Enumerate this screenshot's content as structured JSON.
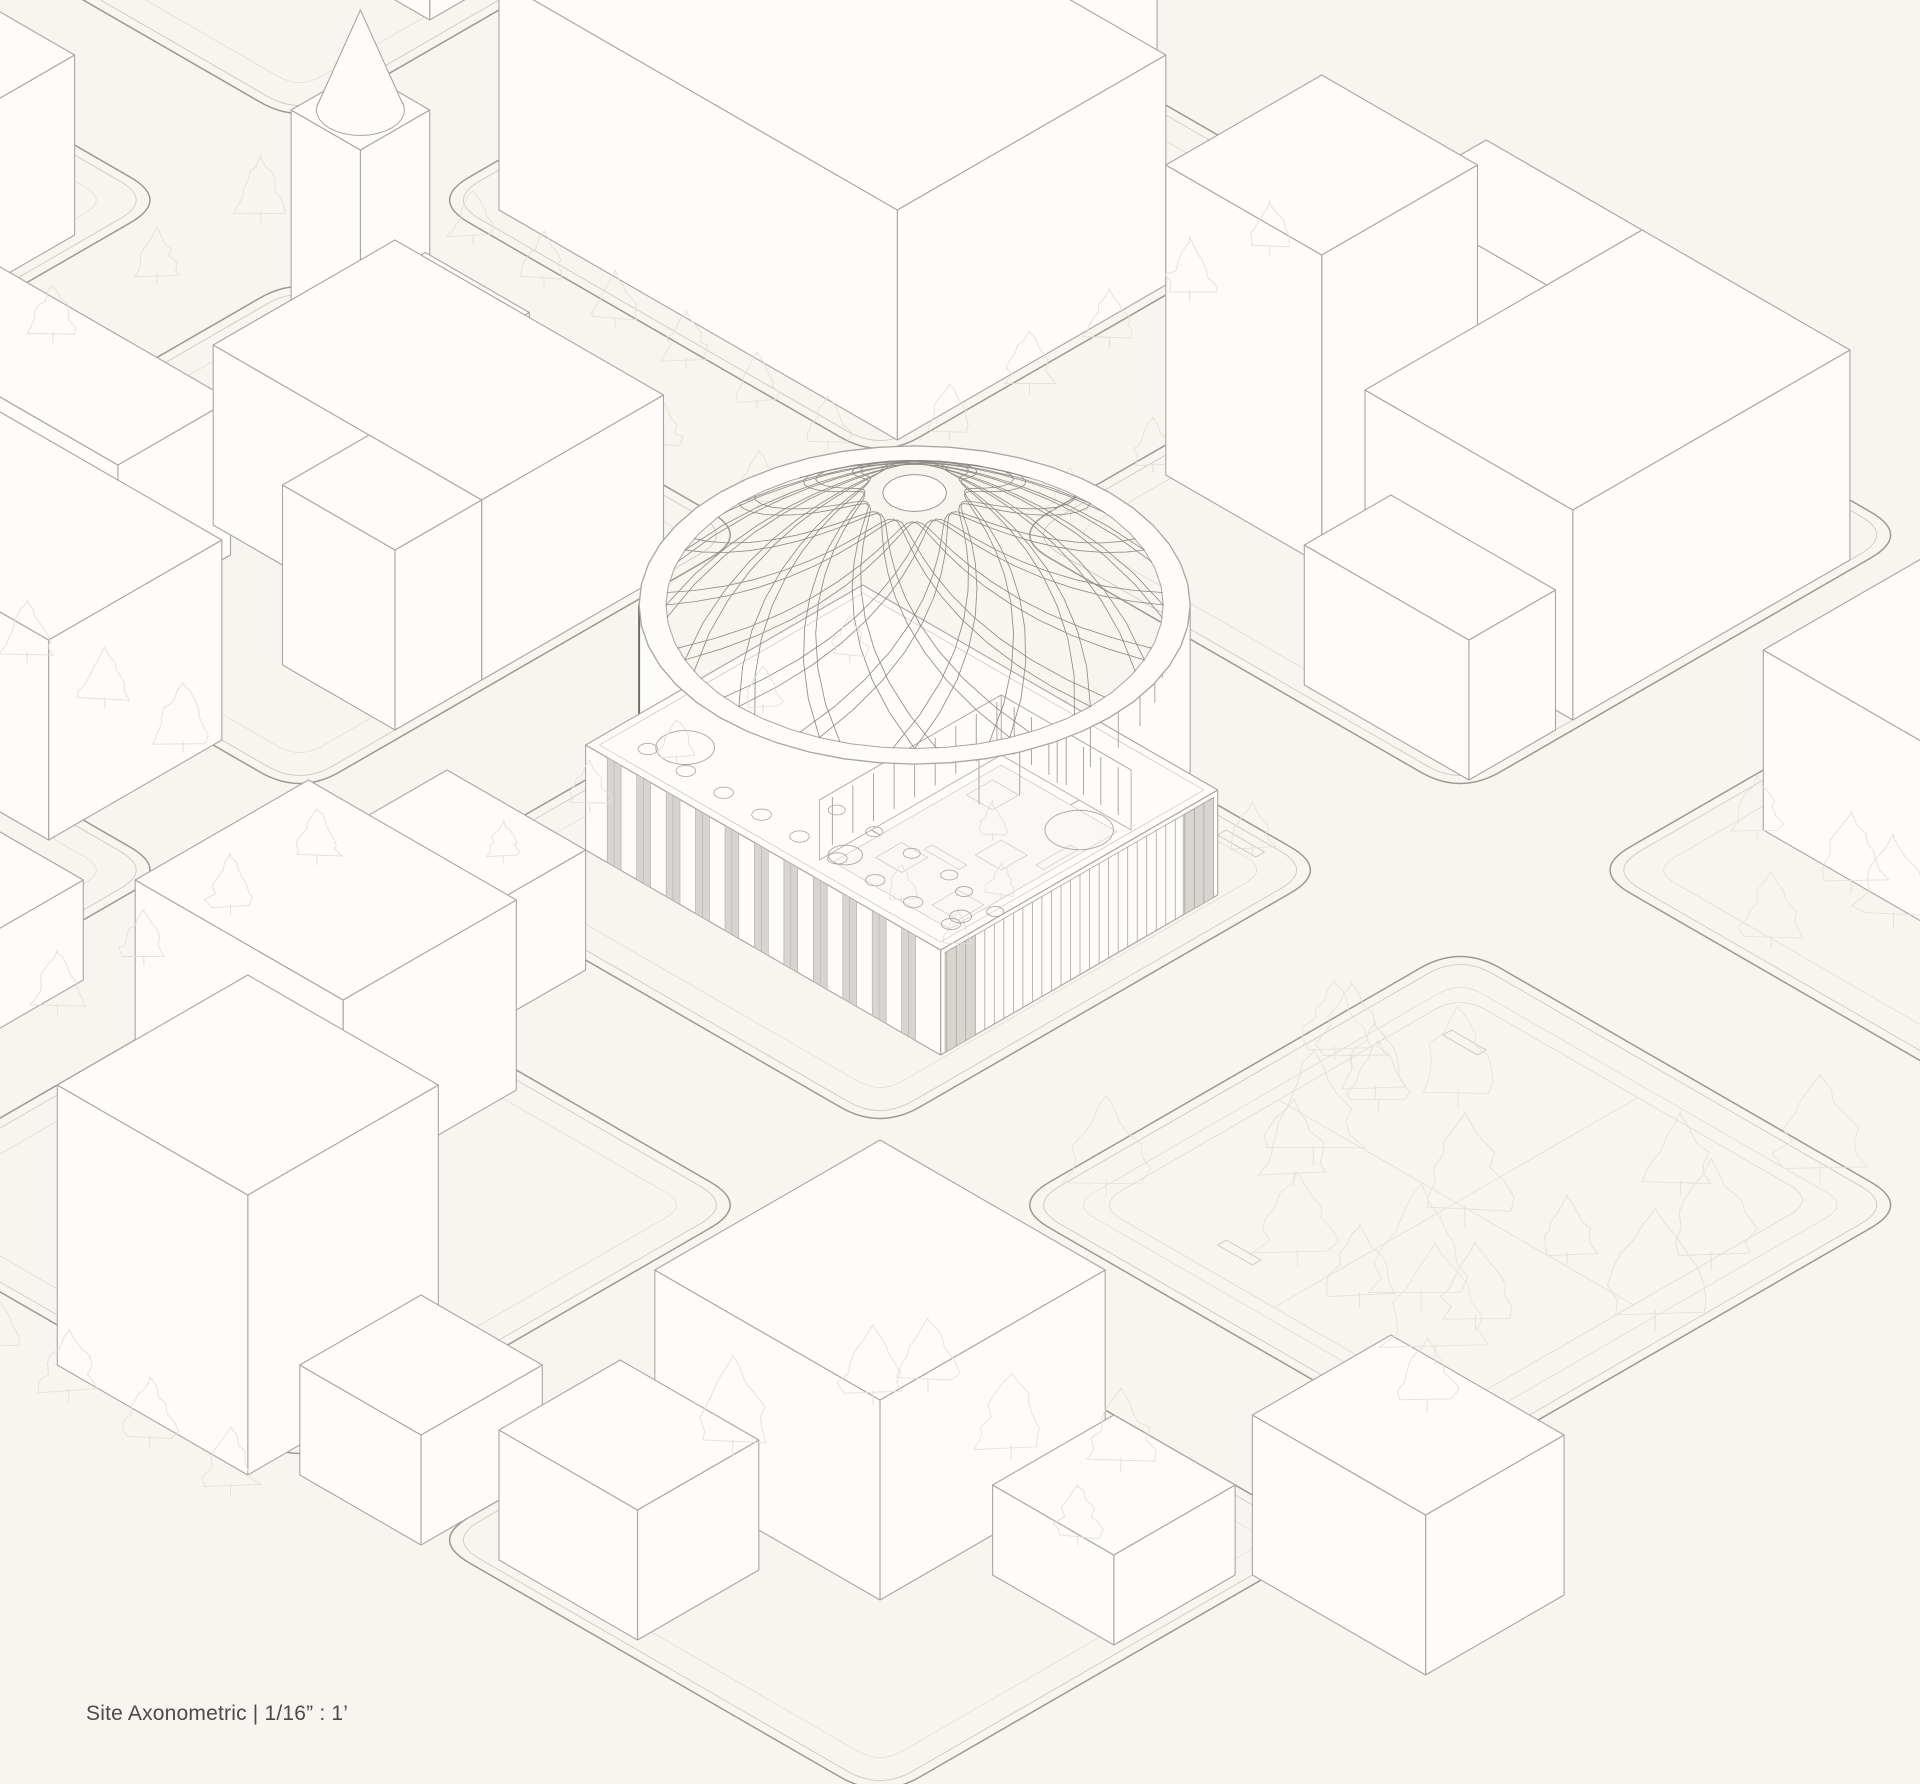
{
  "caption": {
    "label": "Site Axonometric",
    "divider": "|",
    "scale": "1/16” : 1’"
  },
  "colors": {
    "paper": "#f8f5f1",
    "face": "#fdfcfa",
    "ink": "#a9a6a1",
    "inkSoft": "#c9c5c0",
    "inkFaint": "#ddd9d4",
    "curb": "#9c9893",
    "tree": "#e4e0da",
    "treeAlt": "#ebe1dc",
    "dome": "#8f8c88",
    "drumEdge": "#6f6d6a",
    "glassFill": "#d8d5d1",
    "glassEdge": "#aeaba6",
    "caption": "#4b4b4b"
  },
  "projection": {
    "cx": 880,
    "cy": -60,
    "cos": 0.866,
    "sin": 0.5
  },
  "scene": {
    "blocks": [
      {
        "u0": -670,
        "v0": 0,
        "u1": -150,
        "v1": 520,
        "r": 46
      },
      {
        "u0": 0,
        "v0": 0,
        "u1": 520,
        "v1": 520,
        "r": 46
      },
      {
        "u0": 670,
        "v0": 0,
        "u1": 1190,
        "v1": 520,
        "r": 46
      },
      {
        "u0": 1340,
        "v0": 0,
        "u1": 1860,
        "v1": 520,
        "r": 46
      },
      {
        "u0": -670,
        "v0": 670,
        "u1": -150,
        "v1": 1190,
        "r": 46
      },
      {
        "u0": 0,
        "v0": 670,
        "u1": 520,
        "v1": 1190,
        "r": 46
      },
      {
        "u0": 670,
        "v0": 670,
        "u1": 1190,
        "v1": 1190,
        "r": 46
      },
      {
        "u0": 1340,
        "v0": 670,
        "u1": 1860,
        "v1": 1190,
        "r": 46
      },
      {
        "u0": 0,
        "v0": 1340,
        "u1": 520,
        "v1": 1860,
        "r": 46
      },
      {
        "u0": 670,
        "v0": 1340,
        "u1": 1190,
        "v1": 1860,
        "r": 46
      },
      {
        "u0": 1340,
        "v0": 1340,
        "u1": 1860,
        "v1": 1860,
        "r": 46
      }
    ],
    "park": {
      "path": {
        "u0": 1390,
        "v0": 720,
        "u1": 1800,
        "v1": 1140
      },
      "clusters": [
        {
          "u0": 1370,
          "v0": 700,
          "u1": 1840,
          "v1": 1160,
          "n": 20,
          "smin": 70,
          "smax": 135,
          "seed": 7
        },
        {
          "u0": 1400,
          "v0": 1340,
          "u1": 1750,
          "v1": 1700,
          "n": 6,
          "smin": 60,
          "smax": 110,
          "seed": 21
        },
        {
          "u0": 1380,
          "v0": 380,
          "u1": 1580,
          "v1": 520,
          "n": 4,
          "smin": 60,
          "smax": 100,
          "seed": 33
        }
      ]
    },
    "tree_rows": [
      {
        "layer": "back",
        "from": [
          690,
          90
        ],
        "to": [
          690,
          470
        ],
        "n": 5,
        "size": 55
      },
      {
        "layer": "back",
        "from": [
          160,
          640
        ],
        "to": [
          500,
          640
        ],
        "n": 4,
        "size": 55
      },
      {
        "layer": "back",
        "from": [
          770,
          700
        ],
        "to": [
          1130,
          700
        ],
        "n": 6,
        "size": 48
      },
      {
        "layer": "front",
        "from": [
          705,
          740
        ],
        "to": [
          705,
          1140
        ],
        "n": 5,
        "size": 48
      },
      {
        "layer": "front",
        "from": [
          540,
          90
        ],
        "to": [
          540,
          460
        ],
        "n": 5,
        "size": 58
      },
      {
        "layer": "front",
        "from": [
          70,
          540
        ],
        "to": [
          480,
          540
        ],
        "n": 6,
        "size": 58
      },
      {
        "layer": "front",
        "from": [
          -40,
          1215
        ],
        "to": [
          410,
          1215
        ],
        "n": 6,
        "size": 62
      },
      {
        "layer": "front",
        "from": [
          -75,
          640
        ],
        "to": [
          -75,
          1120
        ],
        "n": 5,
        "size": 60
      },
      {
        "layer": "front",
        "from": [
          900,
          1930
        ],
        "to": [
          1180,
          1930
        ],
        "n": 4,
        "size": 65
      },
      {
        "layer": "front",
        "from": [
          600,
          1250
        ],
        "to": [
          600,
          1550
        ],
        "n": 4,
        "size": 58
      }
    ],
    "benches": [
      [
        850,
        690,
        44,
        10
      ],
      [
        970,
        690,
        44,
        10
      ],
      [
        1090,
        690,
        44,
        10
      ],
      [
        707,
        810,
        10,
        44
      ],
      [
        707,
        930,
        10,
        44
      ],
      [
        1420,
        760,
        40,
        10
      ],
      [
        1500,
        1100,
        40,
        10
      ]
    ],
    "buildings": [
      {
        "id": "slab-top-center-wing",
        "u0": 50,
        "v0": 60,
        "u1": 380,
        "v1": 180,
        "h": 230
      },
      {
        "id": "slab-top-center-main",
        "u0": 50,
        "v0": 180,
        "u1": 510,
        "v1": 490,
        "h": 230
      },
      {
        "id": "box-top-far-left",
        "u0": -640,
        "v0": 60,
        "u1": -180,
        "v1": 340,
        "h": 190
      },
      {
        "id": "l-top-right-wing",
        "u0": 760,
        "v0": 60,
        "u1": 940,
        "v1": 170,
        "h": 210
      },
      {
        "id": "tower-top-right",
        "u0": 700,
        "v0": 190,
        "u1": 880,
        "v1": 370,
        "h": 310
      },
      {
        "id": "l-top-right-main",
        "u0": 940,
        "v0": 60,
        "u1": 1180,
        "v1": 380,
        "h": 210
      },
      {
        "id": "box-top-right-small",
        "u0": 990,
        "v0": 400,
        "u1": 1180,
        "v1": 500,
        "h": 140
      },
      {
        "id": "box-right-edge",
        "u0": 1400,
        "v0": 140,
        "u1": 1700,
        "v1": 380,
        "h": 180
      },
      {
        "id": "church-tower",
        "u0": 60,
        "v0": 660,
        "u1": 140,
        "v1": 740,
        "h": 230,
        "spire": {
          "r": 36,
          "apex": 100
        }
      },
      {
        "id": "church-nave",
        "u0": 140,
        "v0": 665,
        "u1": 260,
        "v1": 735,
        "h": 90
      },
      {
        "id": "l-church-main",
        "u0": 200,
        "v0": 760,
        "u1": 510,
        "v1": 970,
        "h": 180
      },
      {
        "id": "l-church-wing",
        "u0": 380,
        "v0": 970,
        "u1": 510,
        "v1": 1070,
        "h": 180
      },
      {
        "id": "long-church-block",
        "u0": -60,
        "v0": 990,
        "u1": 240,
        "v1": 1120,
        "h": 155
      },
      {
        "id": "box-upper-left-edge",
        "u0": -560,
        "v0": 760,
        "u1": -170,
        "v1": 1000,
        "h": 180
      },
      {
        "id": "box-left-mid",
        "u0": 120,
        "v0": 1180,
        "u1": 420,
        "v1": 1380,
        "h": 200
      },
      {
        "id": "box-left-low-sliver",
        "u0": 160,
        "v0": 1480,
        "u1": 400,
        "v1": 1700,
        "h": 170
      },
      {
        "id": "cube-left-low",
        "u0": 440,
        "v0": 1500,
        "u1": 580,
        "v1": 1630,
        "h": 100
      },
      {
        "id": "box-bottom-center-a",
        "u0": 700,
        "v0": 1200,
        "u1": 860,
        "v1": 1330,
        "h": 120
      },
      {
        "id": "slab-bottom-center",
        "u0": 700,
        "v0": 1360,
        "u1": 940,
        "v1": 1560,
        "h": 190
      },
      {
        "id": "box-bottom-left-big",
        "u0": 950,
        "v0": 1680,
        "u1": 1170,
        "v1": 1900,
        "h": 280
      },
      {
        "id": "cube-bottom-left",
        "u0": 1200,
        "v0": 1730,
        "u1": 1340,
        "v1": 1870,
        "h": 110
      },
      {
        "id": "box-bottom-right-a",
        "u0": 1400,
        "v0": 1400,
        "u1": 1660,
        "v1": 1660,
        "h": 200
      },
      {
        "id": "cube-bottom-right-b",
        "u0": 1700,
        "v0": 1430,
        "u1": 1840,
        "v1": 1570,
        "h": 90
      },
      {
        "id": "box-bottom-right-c",
        "u0": 1400,
        "v0": 1700,
        "u1": 1560,
        "v1": 1840,
        "h": 130
      },
      {
        "id": "box-bottom-right-edge",
        "u0": 1850,
        "v0": 1260,
        "u1": 2050,
        "v1": 1420,
        "h": 160
      }
    ],
    "mosque": {
      "podium": {
        "u0": 740,
        "v0": 760,
        "u1": 1150,
        "v1": 1080,
        "h": 105
      },
      "drum": {
        "cu": 850,
        "cv": 810,
        "R": 225,
        "wall": 22,
        "ringH": 165,
        "domeH": 112,
        "ribs": 16,
        "spanDeg": 140,
        "capR": 26
      },
      "courtyard": {
        "u0": 930,
        "v0": 790,
        "u1": 1080,
        "v1": 1000,
        "floorH": 45,
        "trees": [
          [
            965,
            835
          ],
          [
            1030,
            890
          ],
          [
            975,
            950
          ],
          [
            1055,
            965
          ]
        ],
        "planterSize": 30,
        "benches": [
          [
            980,
            920,
            40,
            9,
            45
          ],
          [
            1060,
            840,
            9,
            40,
            45
          ]
        ]
      },
      "fins": [
        {
          "axis": "u",
          "u": 935,
          "v0": 800,
          "v1": 990,
          "n": 9,
          "h0": 58,
          "h1": 105
        },
        {
          "axis": "v",
          "v": 795,
          "u0": 950,
          "u1": 1070,
          "n": 7,
          "h0": 58,
          "h1": 105
        }
      ],
      "skylights": [
        [
          1110,
          880,
          28
        ],
        [
          800,
          1025,
          24
        ],
        [
          1000,
          1040,
          14
        ],
        [
          1128,
          1035,
          9
        ],
        [
          1105,
          1008,
          7
        ],
        [
          1143,
          1010,
          7
        ]
      ],
      "skylight_rows": [
        {
          "v": 1048,
          "u0": 780,
          "u1": 1130,
          "n": 9,
          "r": 8
        },
        {
          "v": 1000,
          "u0": 950,
          "u1": 1080,
          "n": 4,
          "r": 7
        }
      ],
      "strips": {
        "v": 1080,
        "u0": 765,
        "u1": 1150,
        "w": 16,
        "gap": 18,
        "h": 105
      },
      "colonnade": {
        "u": 1150,
        "v0": 765,
        "v1": 1075,
        "step": 11,
        "h": 100,
        "panels": [
          [
            1040,
            1075
          ],
          [
            765,
            800
          ]
        ]
      },
      "entry_columns": {
        "anglesDeg": [
          -40,
          -30,
          -20,
          -10,
          0,
          10,
          20,
          30
        ],
        "h0": 105,
        "h1": 163
      }
    }
  }
}
